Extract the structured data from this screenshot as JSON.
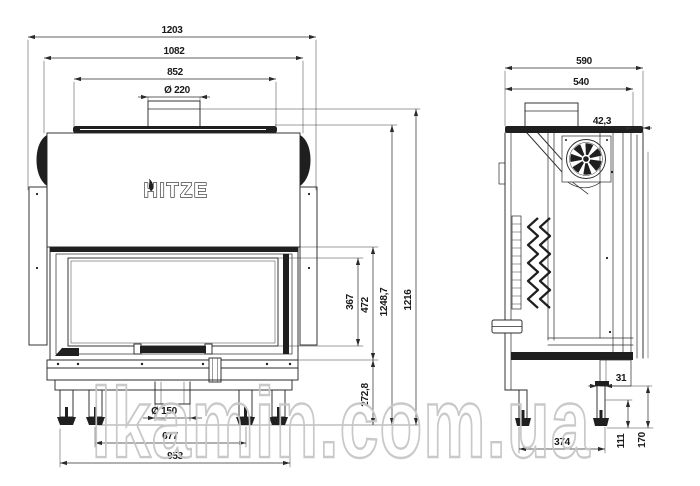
{
  "watermark": {
    "text": "lkamin.com.ua"
  },
  "logo": {
    "text": "HITZE"
  },
  "front_view": {
    "dims": {
      "overall_width": "1203",
      "body_width": "1082",
      "top_plate_width": "852",
      "flue_diameter": "Ø 220",
      "glass_height": "367",
      "door_height": "472",
      "height_with_collar": "1248,7",
      "total_height": "1216",
      "base_height": "272,8",
      "outlet_diameter": "Ø 150",
      "inner_feet_spacing": "677",
      "outer_feet_spacing": "953"
    }
  },
  "side_view": {
    "dims": {
      "overall_depth": "590",
      "body_depth": "540",
      "rear_offset": "42,3",
      "leg_thickness": "31",
      "feet_spacing": "374",
      "foot_height": "111",
      "base_clearance": "170"
    }
  }
}
